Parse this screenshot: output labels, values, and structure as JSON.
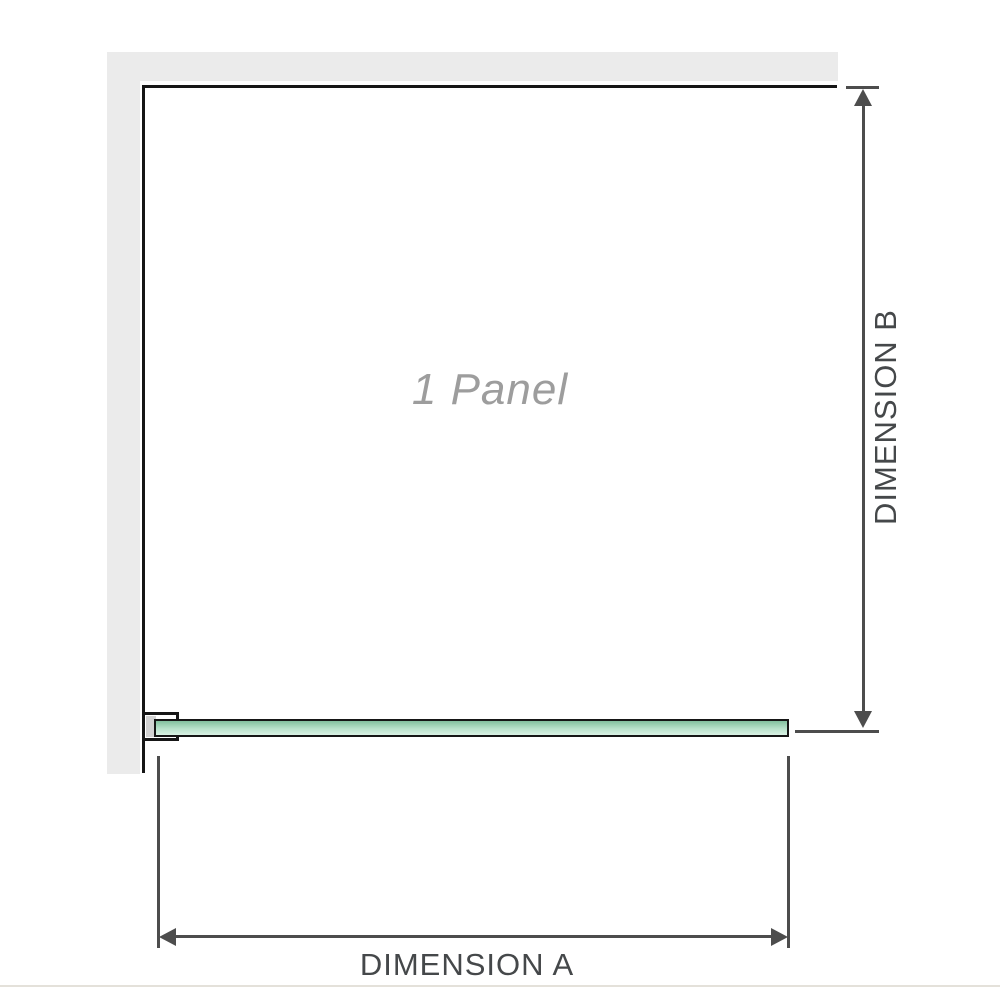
{
  "diagram": {
    "panel_label": "1 Panel",
    "dimension_a_label": "DIMENSION A",
    "dimension_b_label": "DIMENSION B",
    "colors": {
      "wall": "#ebebeb",
      "outline": "#161616",
      "glass_top": "#82c09e",
      "glass_bottom": "#d9f1e4",
      "dimension_line": "#4d4d4d",
      "label_text": "#45484a",
      "panel_text": "#9d9d9d",
      "baseline": "#e4e1da"
    }
  }
}
